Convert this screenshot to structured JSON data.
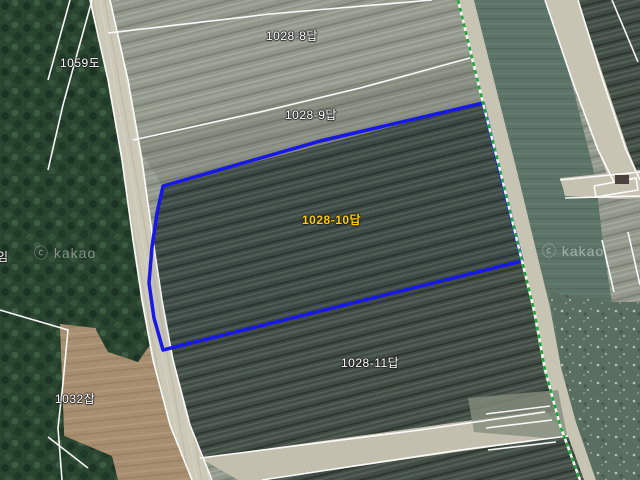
{
  "map": {
    "watermark": "ⓒ kakao",
    "colors": {
      "selection_boundary": "#1717e8",
      "selection_label": "#ffcc00",
      "parcel_line": "#ffffff",
      "admin_boundary": "#1fa53c"
    },
    "selection": {
      "parcel": "1028-10답"
    },
    "labels": [
      {
        "text": "1028-8답"
      },
      {
        "text": "1028-9답"
      },
      {
        "text": "1028-10답"
      },
      {
        "text": "1028-11답"
      },
      {
        "text": "1059도"
      },
      {
        "text": "1032잡"
      },
      {
        "text": "임"
      }
    ]
  }
}
